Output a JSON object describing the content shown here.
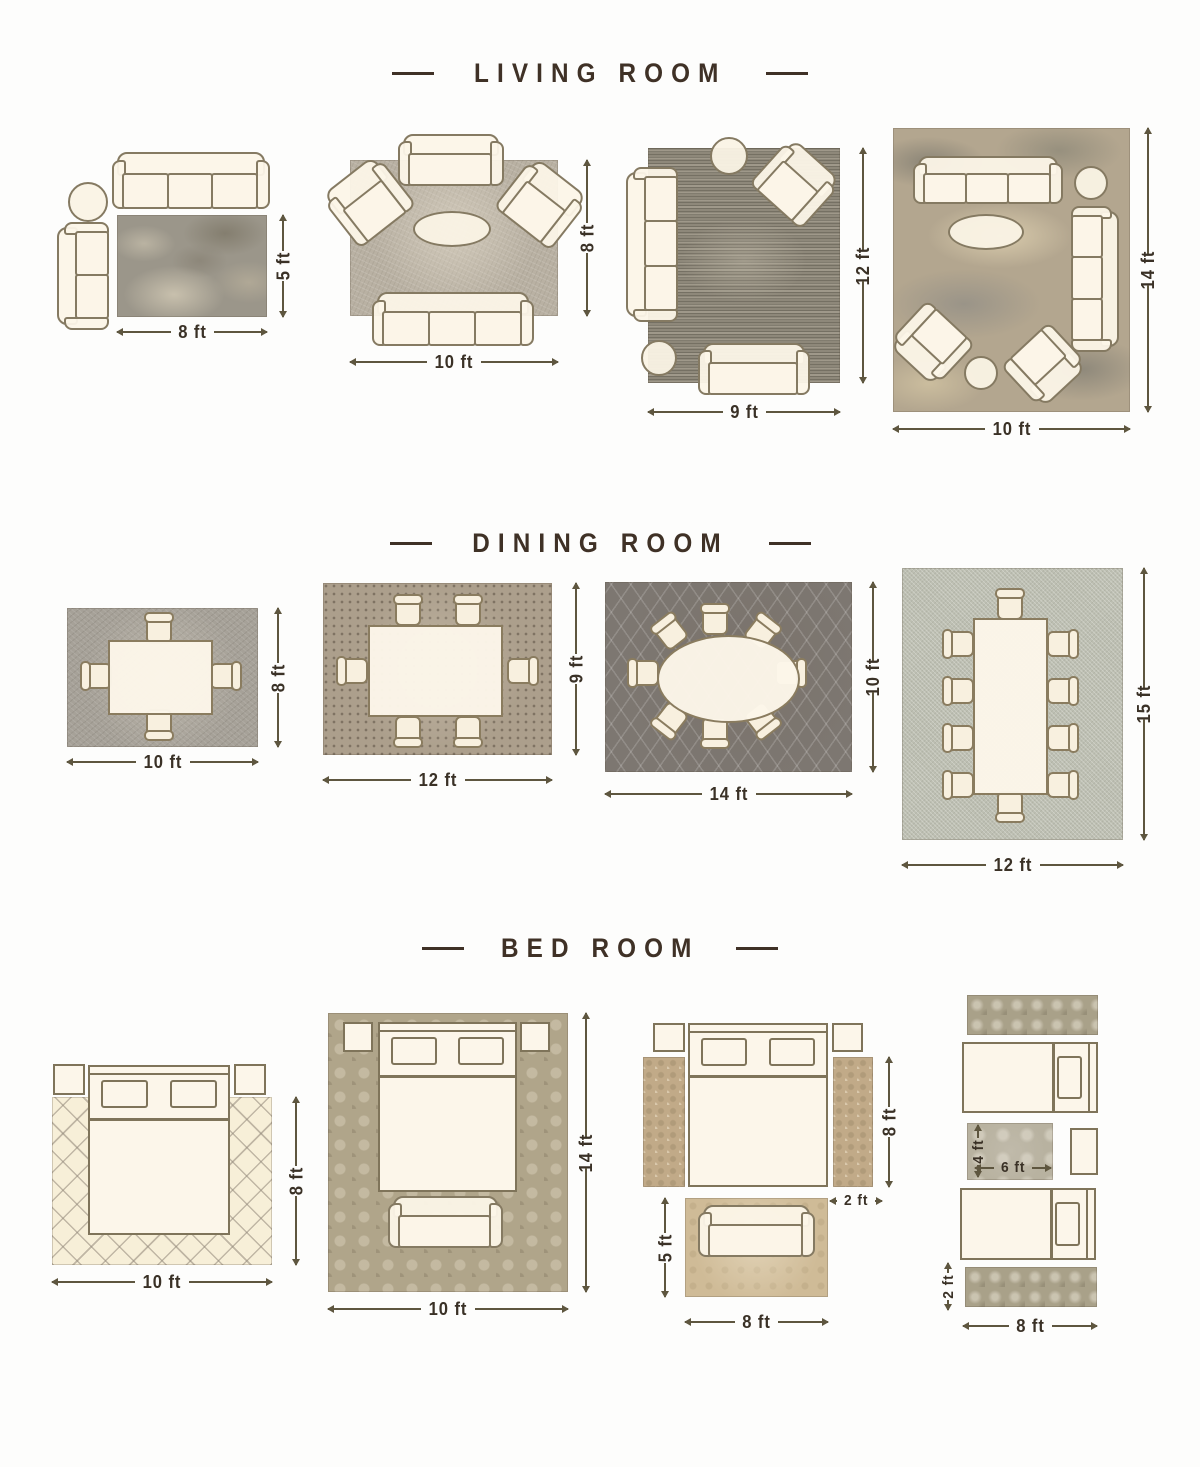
{
  "headings": {
    "living": "LIVING ROOM",
    "dining": "DINING ROOM",
    "bedroom": "BED ROOM"
  },
  "living_room": {
    "layout1": {
      "rug_width": "8 ft",
      "rug_height": "5 ft"
    },
    "layout2": {
      "rug_width": "10 ft",
      "rug_height": "8 ft"
    },
    "layout3": {
      "rug_width": "9 ft",
      "rug_height": "12 ft"
    },
    "layout4": {
      "rug_width": "10 ft",
      "rug_height": "14 ft"
    }
  },
  "dining_room": {
    "layout1": {
      "rug_width": "10 ft",
      "rug_height": "8 ft"
    },
    "layout2": {
      "rug_width": "12 ft",
      "rug_height": "9 ft"
    },
    "layout3": {
      "rug_width": "14 ft",
      "rug_height": "10 ft"
    },
    "layout4": {
      "rug_width": "12 ft",
      "rug_height": "15 ft"
    }
  },
  "bed_room": {
    "layout1": {
      "rug_width": "10 ft",
      "rug_height": "8 ft"
    },
    "layout2": {
      "rug_width": "10 ft",
      "rug_height": "14 ft"
    },
    "layout3": {
      "runner_length": "8 ft",
      "runner_width": "2 ft",
      "foot_rug_width": "8 ft",
      "foot_rug_height": "5 ft"
    },
    "layout4": {
      "middle_rug_width": "6 ft",
      "middle_rug_height": "4 ft",
      "runner_width": "2 ft",
      "runner_length": "8 ft"
    }
  },
  "colors": {
    "heading": "#3f3126",
    "dimension_text": "#3a3126",
    "furniture_fill": "#fbf4e7",
    "furniture_outline": "#857a62",
    "background": "#fdfdfc"
  }
}
